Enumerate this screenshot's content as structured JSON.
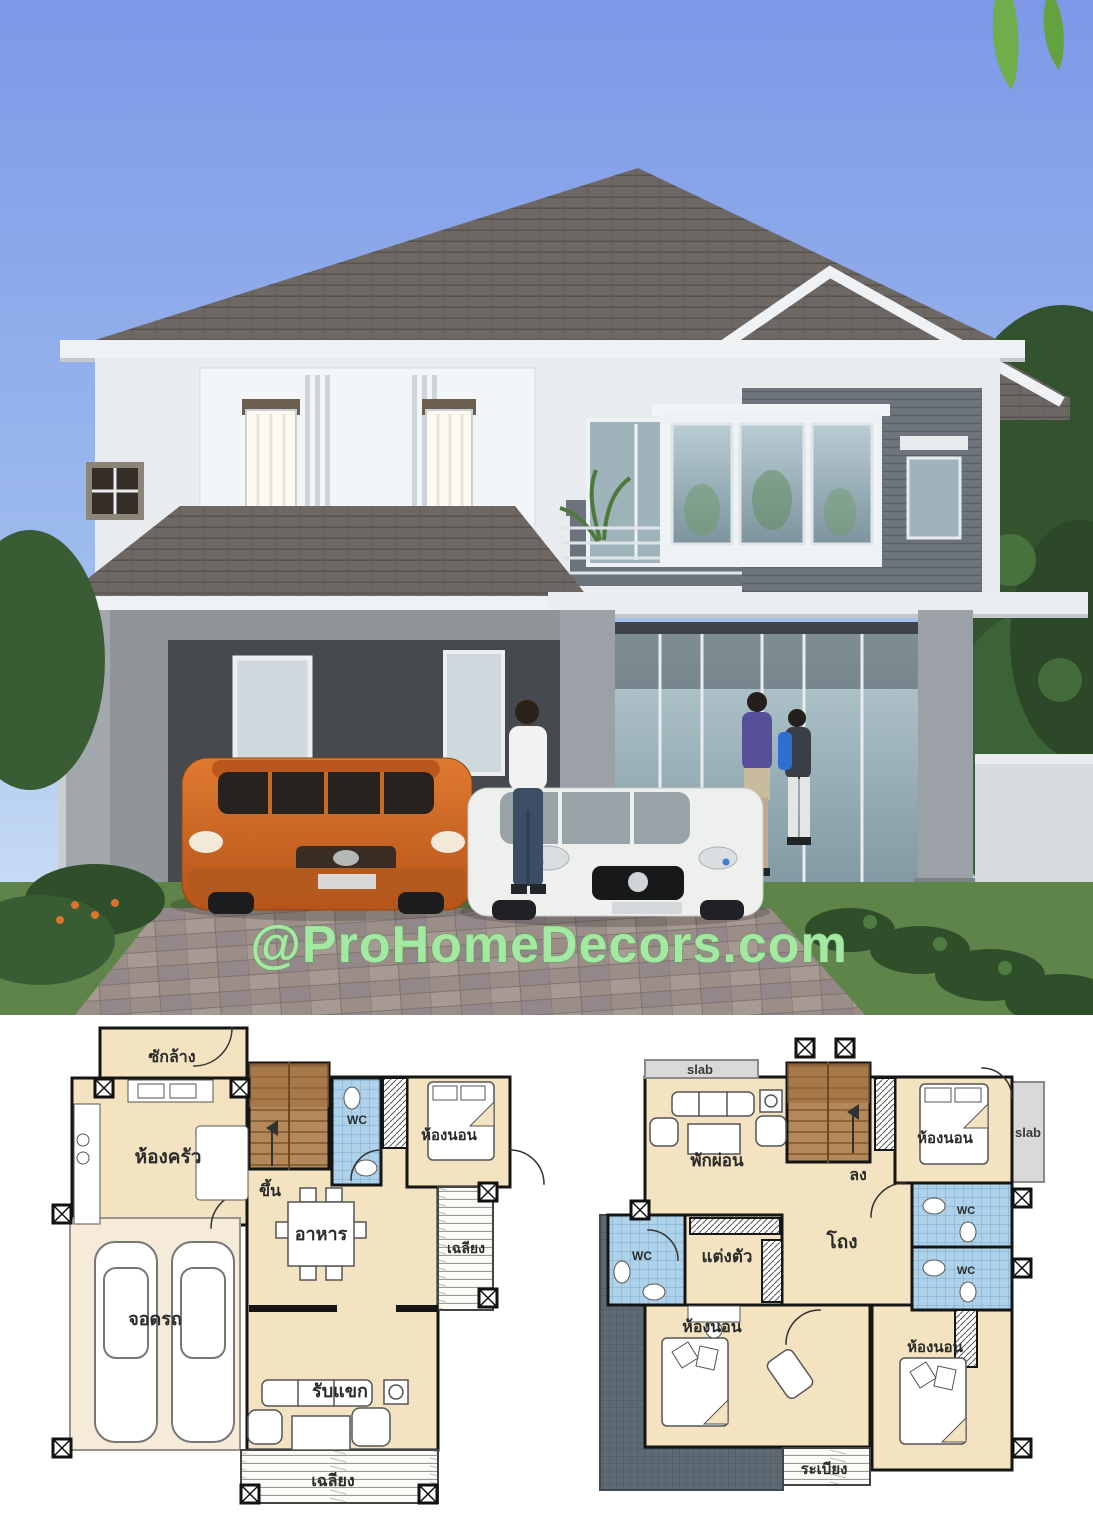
{
  "watermark": {
    "text": "@ProHomeDecors.com"
  },
  "palette": {
    "sky-top": "#7d98e7",
    "sky-bottom": "#d6e8f6",
    "roof": "#6e6864",
    "wall-white": "#f0f3f6",
    "siding": "#6e747c",
    "wall-gray": "#90959a",
    "carport-interior": "#46494e",
    "grass": "#5f8449",
    "foliage": "#33522e",
    "leaf": "#6fae4a",
    "suv-orange": "#d96a24",
    "car-white": "#eef0ee",
    "watermark-green": "#a5e8a2",
    "plan-cream": "#f3e3c1",
    "plan-garage": "#f6ead8",
    "plan-stair": "#b5885a",
    "plan-tile": "#aed2ea",
    "plan-slab": "#d9d9d9",
    "plan-roof": "#5d6973"
  },
  "floor_plans": {
    "first_floor": {
      "labels": {
        "laundry": "ซักล้าง",
        "kitchen": "ห้องครัว",
        "stairs_up": "ขึ้น",
        "wc": "WC",
        "bedroom": "ห้องนอน",
        "dining": "อาหาร",
        "side_porch": "เฉลียง",
        "garage": "จอดรถ",
        "living": "รับแขก",
        "front_porch": "เฉลียง"
      }
    },
    "second_floor": {
      "labels": {
        "slab_top": "slab",
        "family": "พักผ่อน",
        "stairs_down": "ลง",
        "bedroom_top": "ห้องนอน",
        "slab_right": "slab",
        "wc_left": "WC",
        "wc_top": "WC",
        "wc_bottom": "WC",
        "dressing": "แต่งตัว",
        "hall": "โถง",
        "bedroom_left": "ห้องนอน",
        "bedroom_right": "ห้องนอน",
        "balcony": "ระเบียง"
      }
    }
  }
}
